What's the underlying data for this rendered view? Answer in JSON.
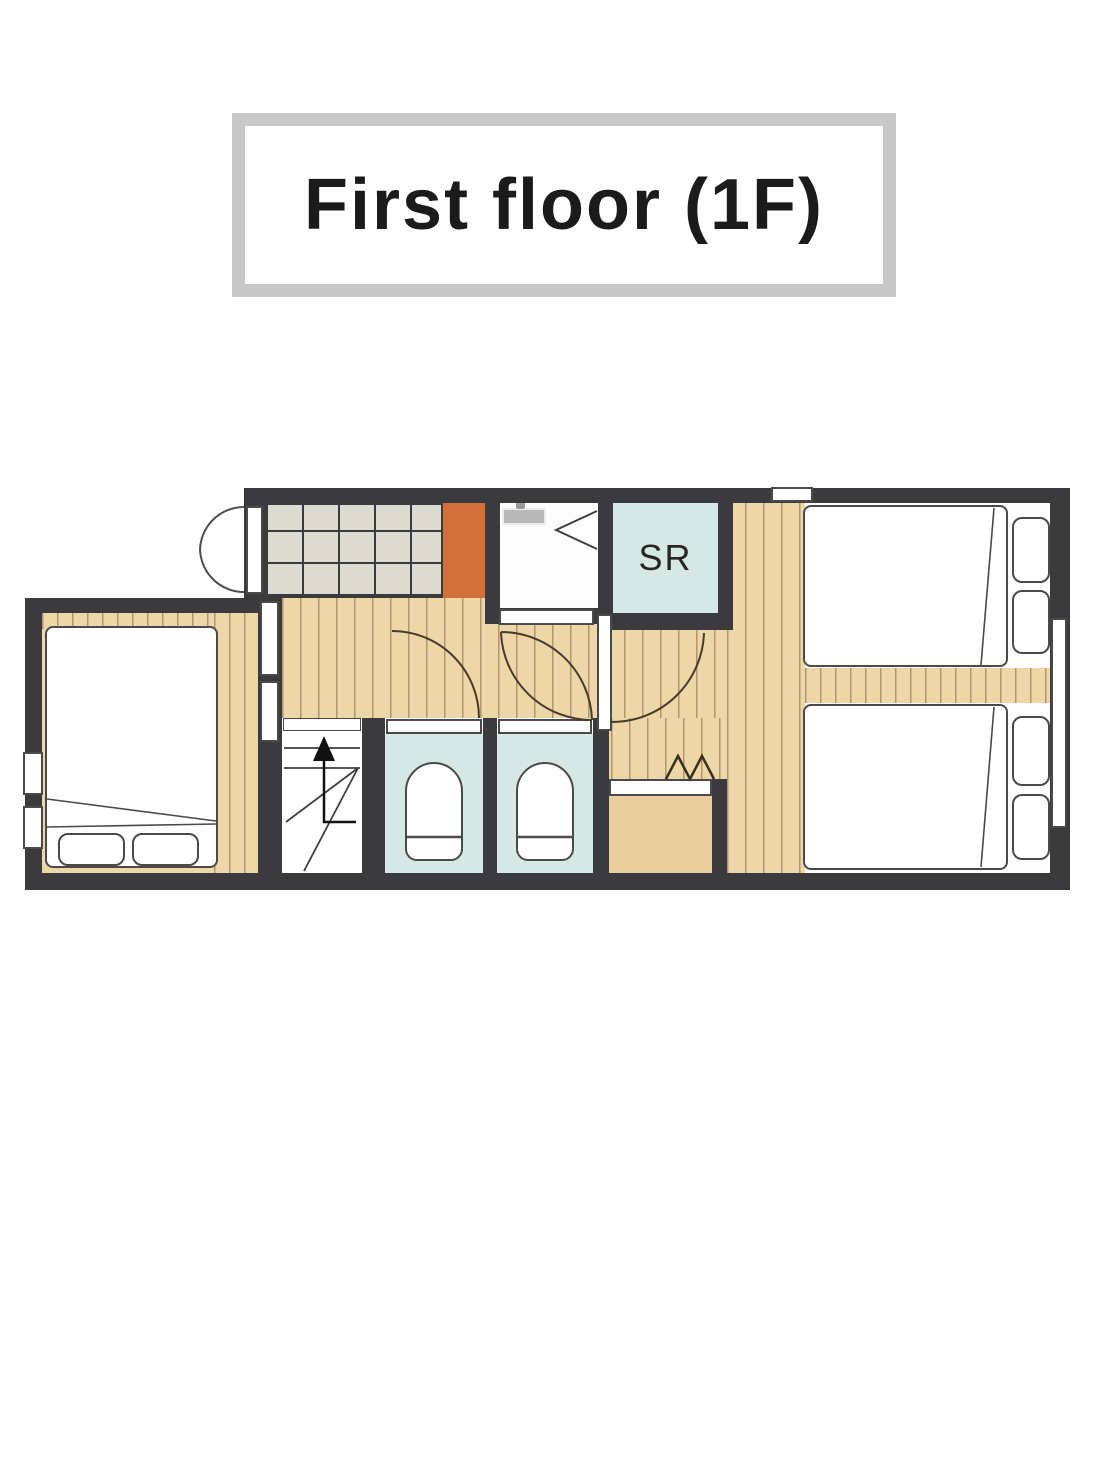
{
  "title": {
    "text": "First floor (1F)"
  },
  "plan": {
    "sr_label": "SR",
    "rooms": [
      {
        "name": "entrance-genkan"
      },
      {
        "name": "washroom"
      },
      {
        "name": "shower-room",
        "label": "SR"
      },
      {
        "name": "hallway"
      },
      {
        "name": "stairs"
      },
      {
        "name": "toilet-1"
      },
      {
        "name": "toilet-2"
      },
      {
        "name": "closet"
      },
      {
        "name": "bedroom-left"
      },
      {
        "name": "bedroom-right"
      }
    ],
    "colors": {
      "wall": "#3b3b3d",
      "wood_floor": "#edd6a7",
      "plank_line": "#7a643c",
      "entrance_tile": "#dcdbd1",
      "entrance_step_orange": "#d2703a",
      "wet_room_blue": "#d6e8e4",
      "closet_tan": "#e9cd9d",
      "fixture_outline": "#4a4a4a",
      "door_arc": "#4a3a28",
      "title_border": "#c8c8c8",
      "title_text": "#1b1b1b"
    }
  }
}
